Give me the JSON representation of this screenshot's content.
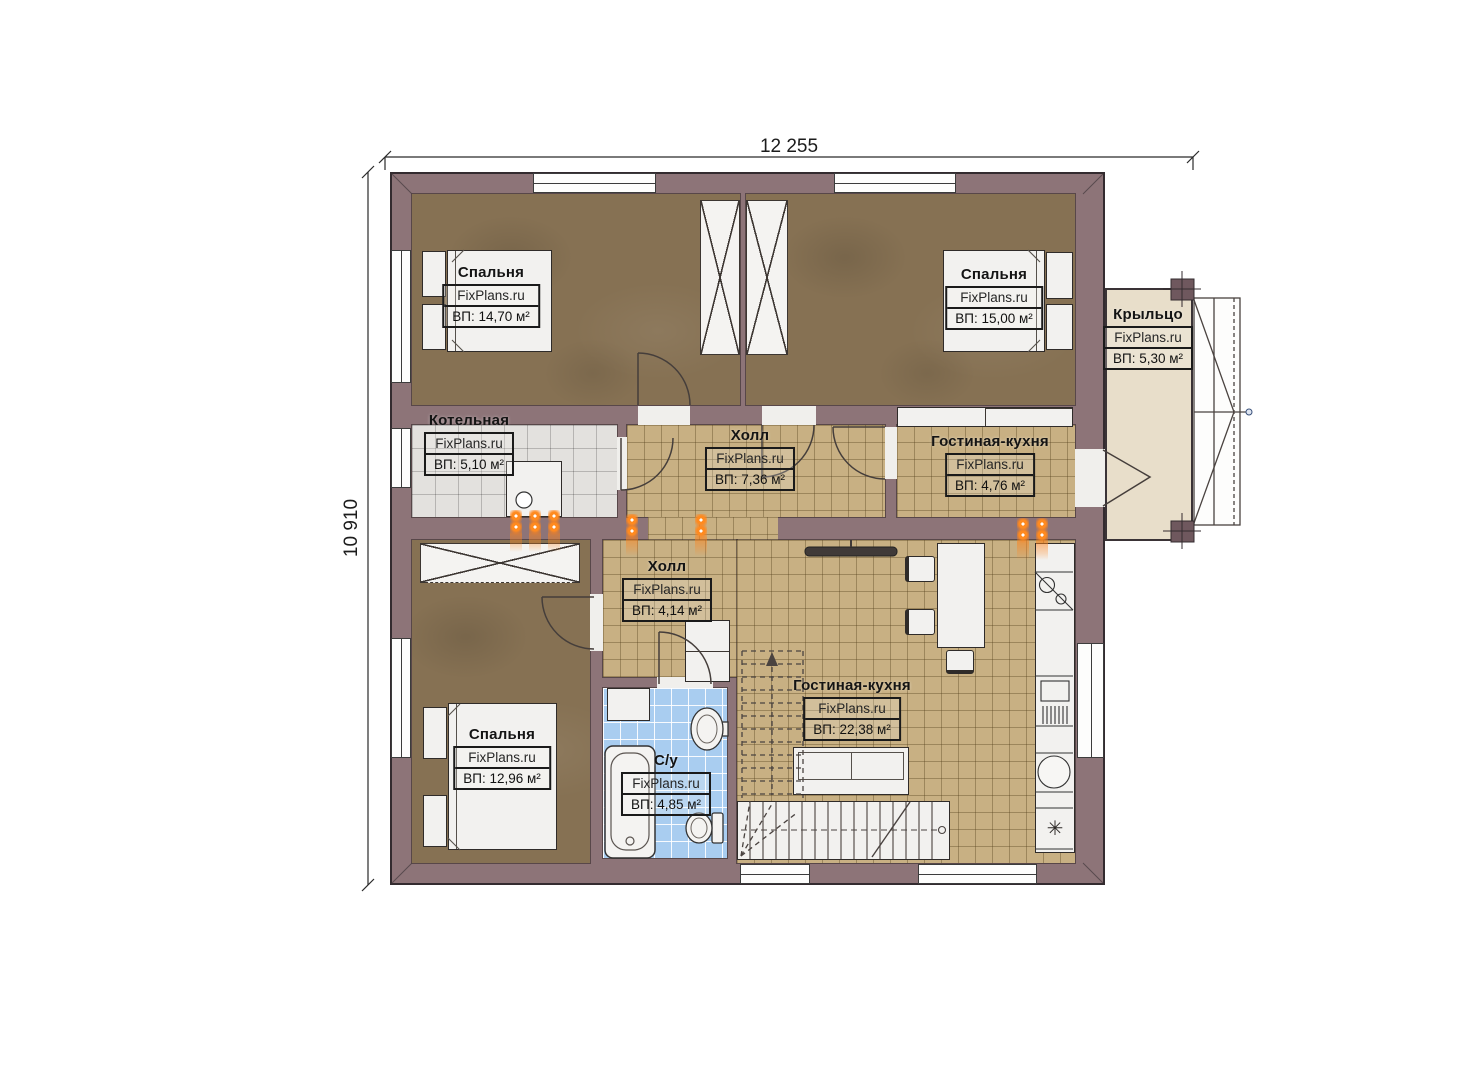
{
  "plan": {
    "dim_width": "12 255",
    "dim_height": "10 910",
    "watermark": "FixPlans.ru",
    "rooms": [
      {
        "name": "Спальня",
        "area": "ВП: 14,70 м²"
      },
      {
        "name": "Спальня",
        "area": "ВП: 15,00 м²"
      },
      {
        "name": "Крыльцо",
        "area": "ВП: 5,30 м²"
      },
      {
        "name": "Котельная",
        "area": "ВП: 5,10 м²"
      },
      {
        "name": "Холл",
        "area": "ВП: 7,36 м²"
      },
      {
        "name": "Гостиная-кухня",
        "area": "ВП: 4,76 м²"
      },
      {
        "name": "Холл",
        "area": "ВП: 4,14 м²"
      },
      {
        "name": "Спальня",
        "area": "ВП: 12,96 м²"
      },
      {
        "name": "С/у",
        "area": "ВП: 4,85 м²"
      },
      {
        "name": "Гостиная-кухня",
        "area": "ВП: 22,38 м²"
      }
    ],
    "colors": {
      "wall": "#8d7478",
      "floor_wood": "#867153",
      "tile_tan": "#c8b083",
      "tile_gray": "#e3e1de",
      "tile_blue": "#a9cdf0",
      "porch": "#e8deca",
      "radiator_orange": "#ff8a1f"
    },
    "icons": {
      "fridge_snowflake": "✳"
    }
  }
}
